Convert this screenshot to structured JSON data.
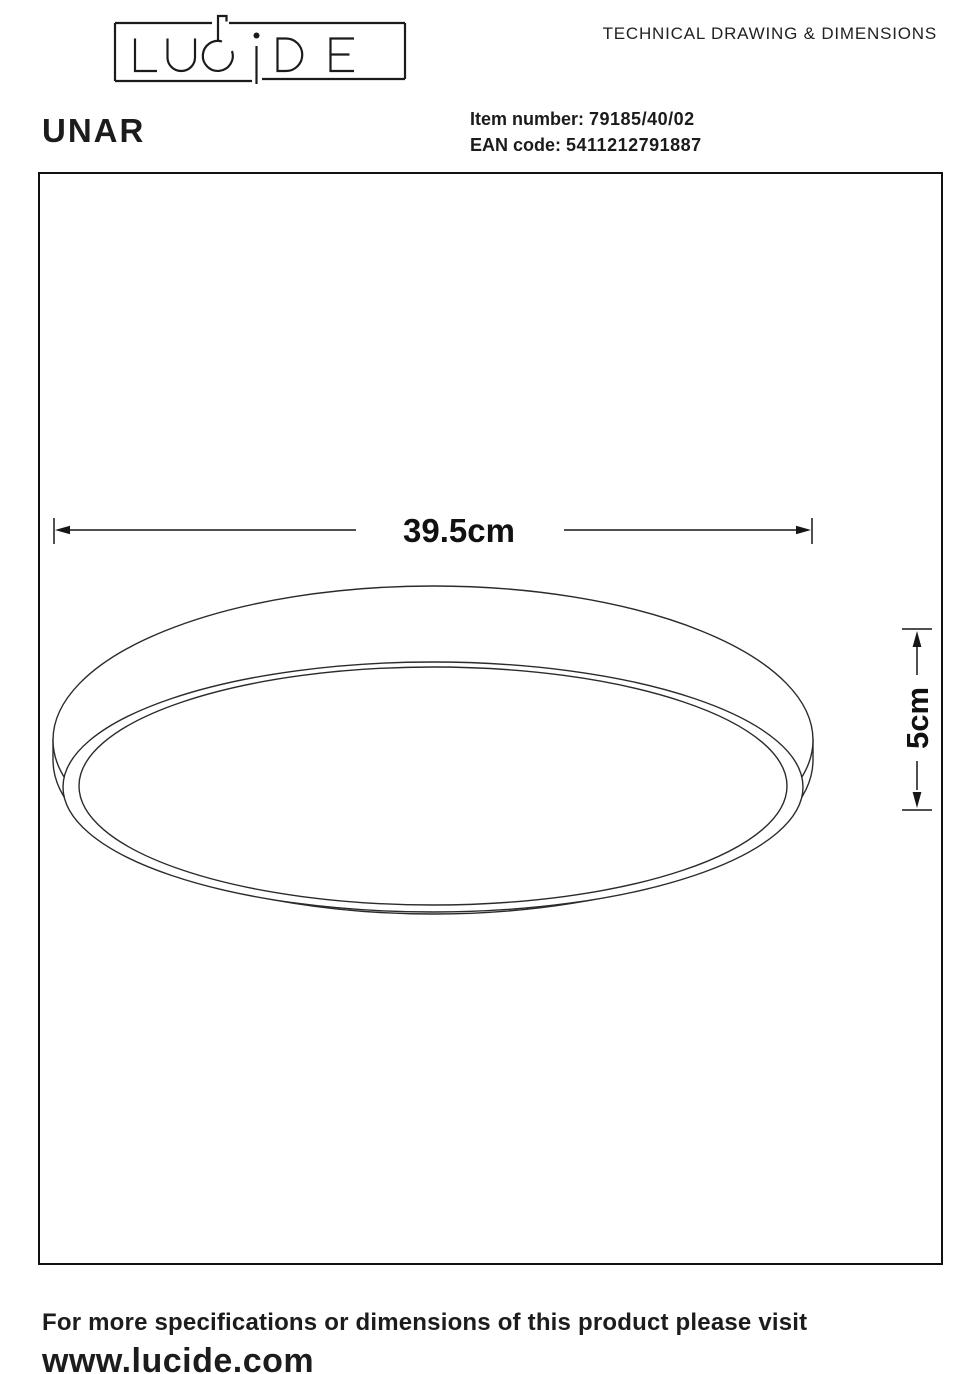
{
  "brand": "LUCIDE",
  "header": {
    "title": "TECHNICAL DRAWING & DIMENSIONS"
  },
  "product": {
    "name": "UNAR",
    "item_number_label": "Item number:",
    "item_number": "79185/40/02",
    "ean_label": "EAN code:",
    "ean": "5411212791887"
  },
  "drawing": {
    "subject": "round ceiling light, side/bottom perspective view",
    "width_label": "39.5cm",
    "height_label": "5cm",
    "line_color": "#2b2b2b"
  },
  "footer": {
    "line1": "For more specifications or dimensions of this product please visit",
    "line2": "www.lucide.com"
  }
}
